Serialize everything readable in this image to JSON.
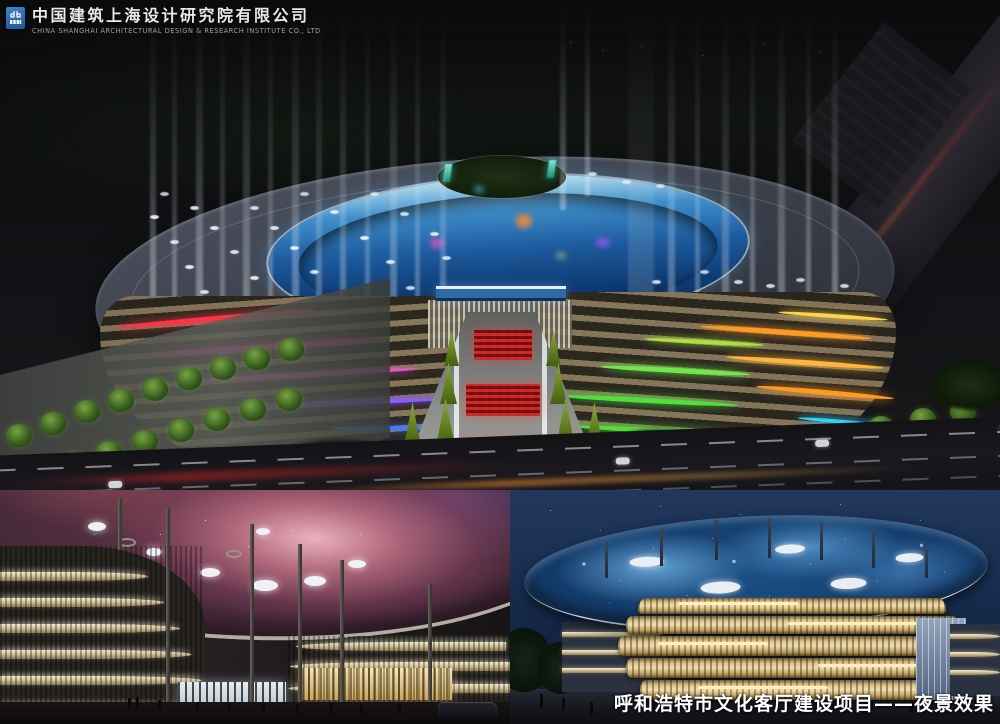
{
  "header": {
    "company_name_zh": "中国建筑上海设计研究院有限公司",
    "company_name_en": "CHINA SHANGHAI ARCHITECTURAL DESIGN & RESEARCH INSTITUTE CO., LTD"
  },
  "caption": {
    "text": "呼和浩特市文化客厅建设项目——夜景效果"
  },
  "colors": {
    "logo_blue": "#2f6db0",
    "neon_red": "#ff3347",
    "neon_magenta": "#ff2fa8",
    "neon_purple": "#8a5bff",
    "neon_blue": "#3f79ff",
    "neon_cyan": "#2ad4ff",
    "neon_green": "#4fe03a",
    "neon_orange": "#ff9a1e",
    "neon_yellow": "#ffd34a",
    "canopy_nebula_pink": "#c96f85",
    "roof_disc_blue": "#2e6fae",
    "facade_gold": "#e6d4a0",
    "caption_white": "#ffffff"
  }
}
